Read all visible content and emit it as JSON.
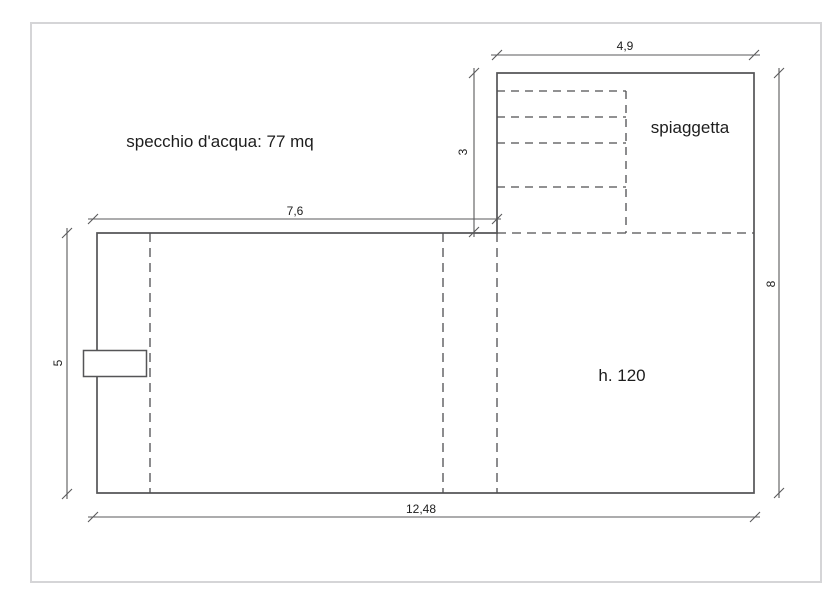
{
  "drawing": {
    "labels": {
      "water_area": "specchio d'acqua: 77 mq",
      "beach": "spiaggetta",
      "depth": "h. 120"
    },
    "dimensions": {
      "beach_width": "4,9",
      "beach_depth": "3",
      "pool_inner_width": "7,6",
      "pool_left_height": "5",
      "overall_right_height": "8",
      "overall_width": "12,48"
    },
    "colors": {
      "outline_line": "#555557",
      "dashed_line": "#4f4f51",
      "dimension_line": "#59595b",
      "text": "#1d1d1d",
      "frame_border": "#d5d5d7",
      "background": "#ffffff"
    }
  }
}
